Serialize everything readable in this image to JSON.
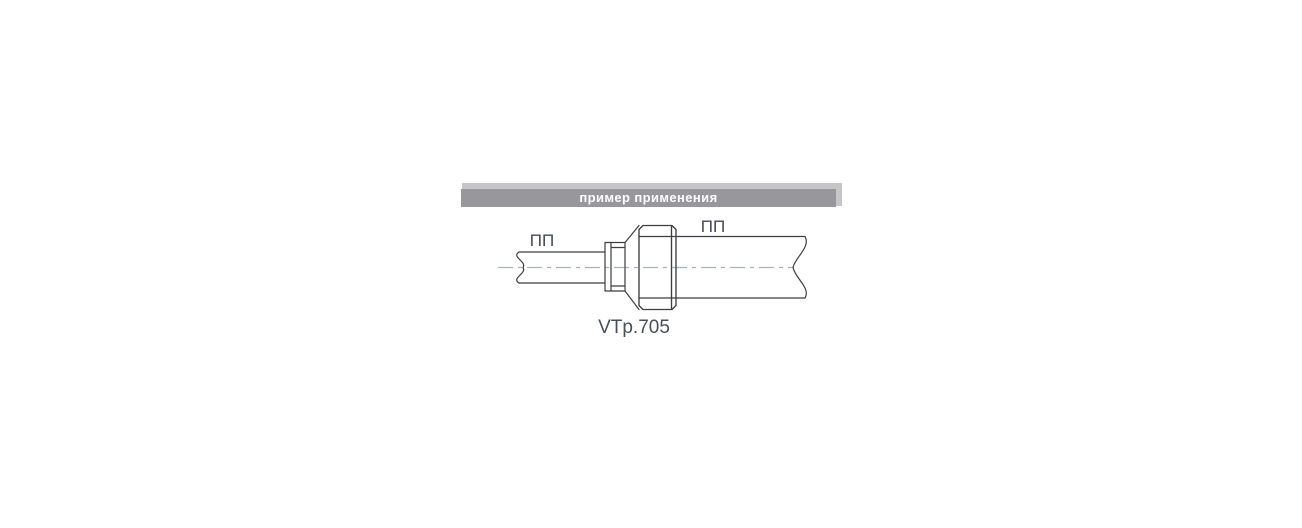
{
  "header": {
    "title": "пример применения",
    "bar_color": "#98989c",
    "backplate_color": "#c6c6c8",
    "text_color": "#ffffff"
  },
  "diagram": {
    "left_pipe_label": "ПП",
    "right_pipe_label": "ПП",
    "part_number": "VTp.705",
    "line_color": "#3d3d42",
    "centerline_color": "#9fb9c0",
    "label_color": "#434a54",
    "part_number_color": "#4a4f58"
  }
}
